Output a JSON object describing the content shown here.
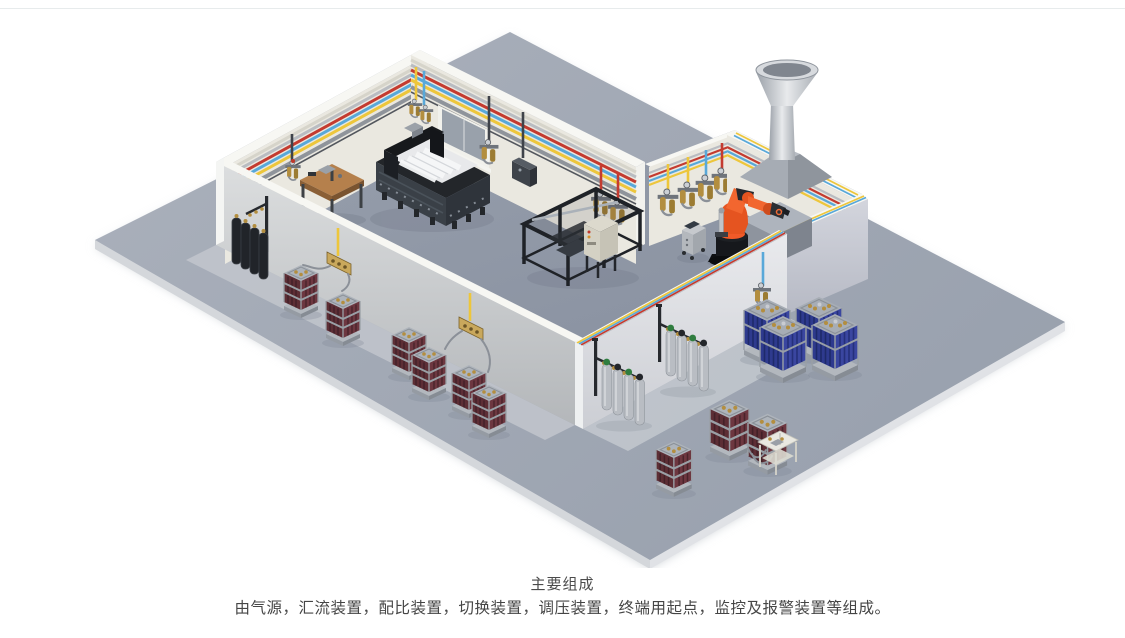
{
  "caption": {
    "title": "主要组成",
    "description": "由气源，汇流装置，配比装置，切换装置，调压装置，终端用起点，监控及报警装置等组成。"
  },
  "scene": {
    "palette": {
      "divider": "#e7ebec",
      "floor_top": "#a3aab6",
      "floor_inner": "#8f97a5",
      "wall_face": "#eae8e0",
      "wall_cap": "#f7f7f3",
      "pipe_silver": "#b9bcc1",
      "pipe_red": "#c43b30",
      "pipe_blue": "#58a8d9",
      "pipe_yellow": "#edc63b",
      "brass": "#b38e3f",
      "robot_orange": "#f05a28",
      "rack_maroon": "#5d2e35",
      "rack_maroon_light": "#6d3740",
      "rack_blue": "#2e3a8e",
      "rack_blue_light": "#3a46a0",
      "cyl_black": "#212429",
      "cyl_silver": "#b9bdc3",
      "cap_green": "#2f7d3f",
      "hose": "#8b9098",
      "wood": "#b5804c",
      "title_color": "#4b4b4b",
      "desc_color": "#454545"
    },
    "objects": [
      "colored-gas-pipelines",
      "gas-outlet-stations",
      "wall-window",
      "workbench",
      "cnc-machine",
      "frame-machine",
      "control-cabinet",
      "control-cart",
      "industrial-robot",
      "robot-pedestal",
      "exhaust-hood-chimney",
      "black-gas-cylinders",
      "maroon-cylinder-bundle-racks",
      "silver-cylinder-groups",
      "blue-cylinder-bundle-racks",
      "gas-control-stand",
      "connection-hoses"
    ]
  }
}
